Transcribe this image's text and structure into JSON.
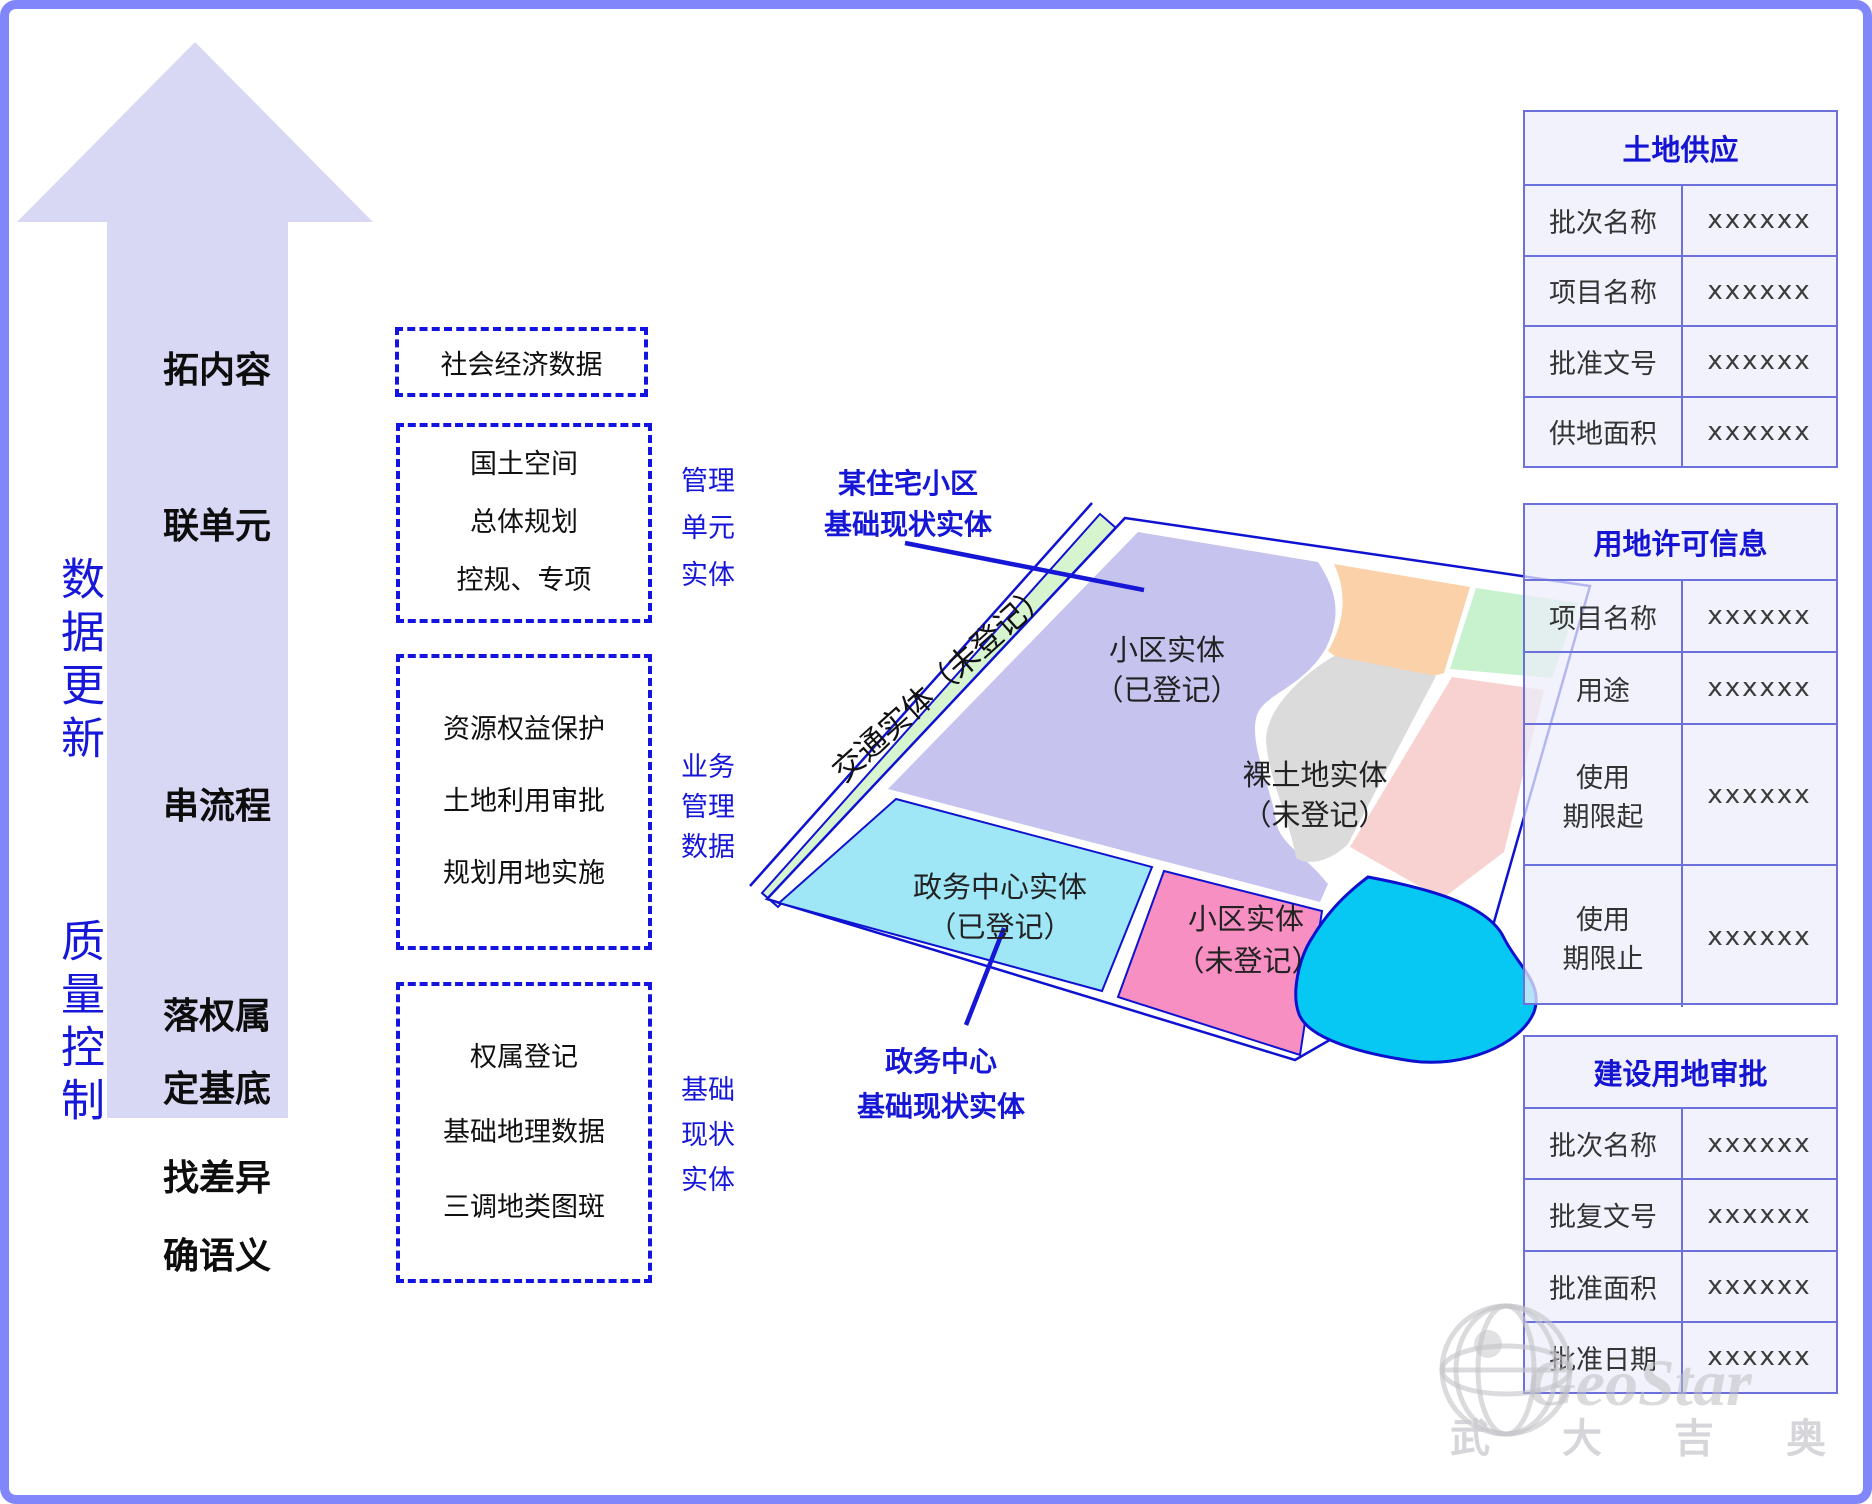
{
  "left_flow": {
    "vertical_labels": [
      "数据更新",
      "质量控制"
    ],
    "arrow_steps": [
      "拓内容",
      "联单元",
      "串流程",
      "落权属",
      "定基底",
      "找差异",
      "确语义"
    ]
  },
  "data_boxes": [
    {
      "lines": [
        "社会经济数据"
      ]
    },
    {
      "lines": [
        "国土空间",
        "总体规划",
        "控规、专项"
      ]
    },
    {
      "lines": [
        "资源权益保护",
        "土地利用审批",
        "规划用地实施"
      ]
    },
    {
      "lines": [
        "权属登记",
        "基础地理数据",
        "三调地类图斑"
      ]
    }
  ],
  "entity_labels": [
    {
      "lines": [
        "管理",
        "单元",
        "实体"
      ]
    },
    {
      "lines": [
        "业务",
        "管理",
        "数据"
      ]
    },
    {
      "lines": [
        "基础",
        "现状",
        "实体"
      ]
    }
  ],
  "map": {
    "road_label": "交通实体（未登记）",
    "parcels": {
      "residential_registered": [
        "小区实体",
        "（已登记）"
      ],
      "bare_land": [
        "裸土地实体",
        "（未登记）"
      ],
      "gov_center": [
        "政务中心实体",
        "（已登记）"
      ],
      "residential_unregistered": [
        "小区实体",
        "（未登记）"
      ]
    },
    "annotations": {
      "top": [
        "某住宅小区",
        "基础现状实体"
      ],
      "bottom": [
        "政务中心",
        "基础现状实体"
      ]
    },
    "colors": {
      "road_green": "#d6f5cf",
      "parcel_purple": "#c6c4ef",
      "parcel_peach": "#fad1a9",
      "parcel_green": "#c8f1cd",
      "parcel_salmon": "#f8d2d0",
      "parcel_gray": "#dbdbdb",
      "parcel_cyan": "#9fe7f7",
      "parcel_pink": "#f78fc3",
      "water_blue": "#06c8f3",
      "outline_blue": "#0f12d0"
    }
  },
  "tables": [
    {
      "title": "土地供应",
      "rows": [
        [
          "批次名称",
          "xxxxxx"
        ],
        [
          "项目名称",
          "xxxxxx"
        ],
        [
          "批准文号",
          "xxxxxx"
        ],
        [
          "供地面积",
          "xxxxxx"
        ]
      ]
    },
    {
      "title": "用地许可信息",
      "rows": [
        [
          "项目名称",
          "xxxxxx"
        ],
        [
          "用途",
          "xxxxxx"
        ],
        [
          "使用\n期限起",
          "xxxxxx"
        ],
        [
          "使用\n期限止",
          "xxxxxx"
        ]
      ]
    },
    {
      "title": "建设用地审批",
      "rows": [
        [
          "批次名称",
          "xxxxxx"
        ],
        [
          "批复文号",
          "xxxxxx"
        ],
        [
          "批准面积",
          "xxxxxx"
        ],
        [
          "批准日期",
          "xxxxxx"
        ]
      ]
    }
  ],
  "watermark": {
    "logo_text": "GeoStar",
    "company": "武大吉奥"
  },
  "accent_colors": {
    "frame": "#8186fa",
    "arrow_fill": "#d8d8f4",
    "blue_text": "#1717d9",
    "table_border": "#6b70da"
  }
}
